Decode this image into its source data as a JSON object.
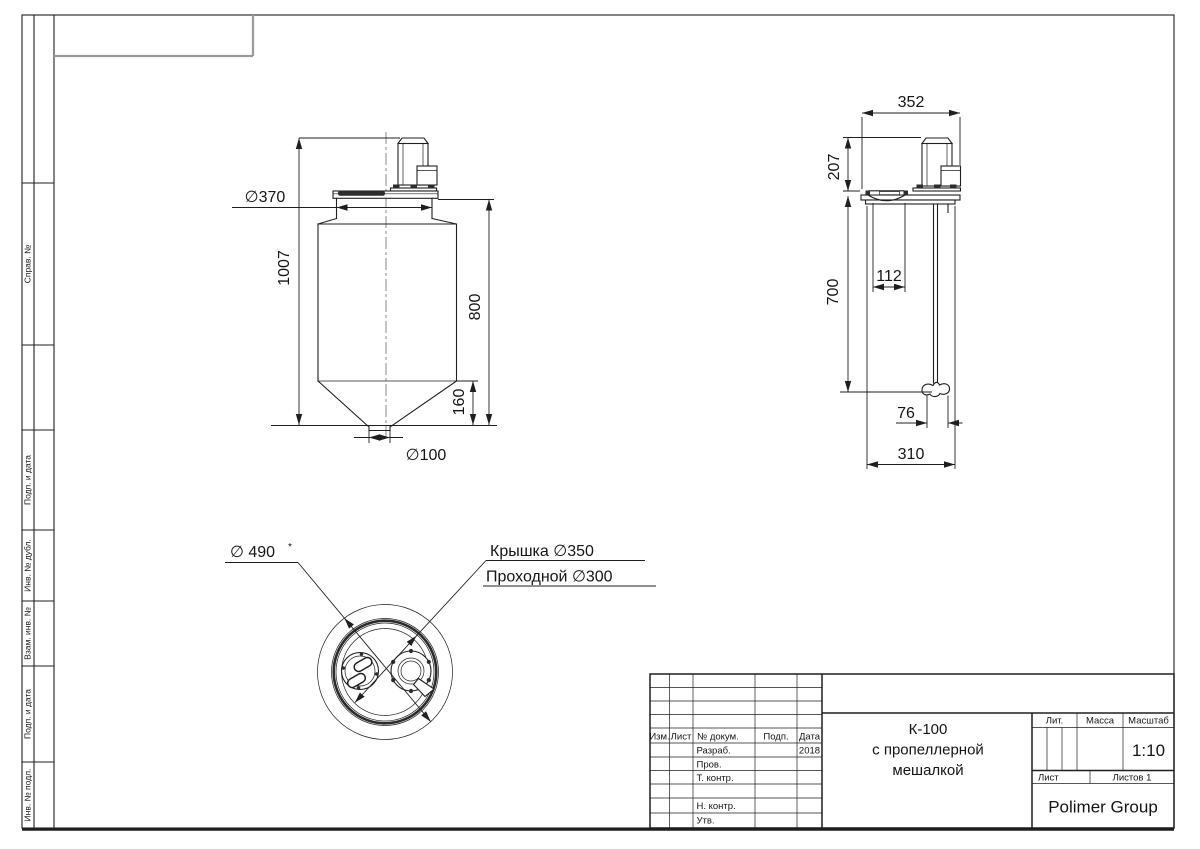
{
  "colors": {
    "line": "#1f1f1f",
    "dark_fill": "#2c2c2c",
    "stamp_gray": "#9a9a9a",
    "background": "#ffffff"
  },
  "sidebar": {
    "labels": [
      "Справ. №",
      "Подп. и дата",
      "Инв. № дубл.",
      "Взам. инв. №",
      "Подп. и дата",
      "Инв. № подл."
    ]
  },
  "front_view": {
    "dims": {
      "d370": "∅370",
      "h1007": "1007",
      "h800": "800",
      "h160": "160",
      "d100": "∅100"
    }
  },
  "side_view": {
    "dims": {
      "w352": "352",
      "h207": "207",
      "h700": "700",
      "w112": "112",
      "w76": "76",
      "w310": "310"
    }
  },
  "plan_view": {
    "labels": {
      "d490": "∅ 490",
      "d490_star": "*",
      "cover": "Крышка  ∅350",
      "passage": "Проходной ∅300"
    }
  },
  "title_block": {
    "header": {
      "izm": "Изм.",
      "sheet": "Лист",
      "doc_no": "№ докум.",
      "sign": "Подп.",
      "date": "Дата"
    },
    "rows": [
      {
        "label": "Разраб.",
        "date": "2018"
      },
      {
        "label": "Пров.",
        "date": ""
      },
      {
        "label": "Т. контр.",
        "date": ""
      },
      {
        "label": "",
        "date": ""
      },
      {
        "label": "Н. контр.",
        "date": ""
      },
      {
        "label": "Утв.",
        "date": ""
      }
    ],
    "title_line1": "К-100",
    "title_line2": "с пропеллерной",
    "title_line3": "мешалкой",
    "lit_label": "Лит.",
    "mass_label": "Масса",
    "scale_label": "Масштаб",
    "scale_value": "1:10",
    "sheet_label": "Лист",
    "sheets_label": "Листов 1",
    "company": "Polimer Group"
  }
}
